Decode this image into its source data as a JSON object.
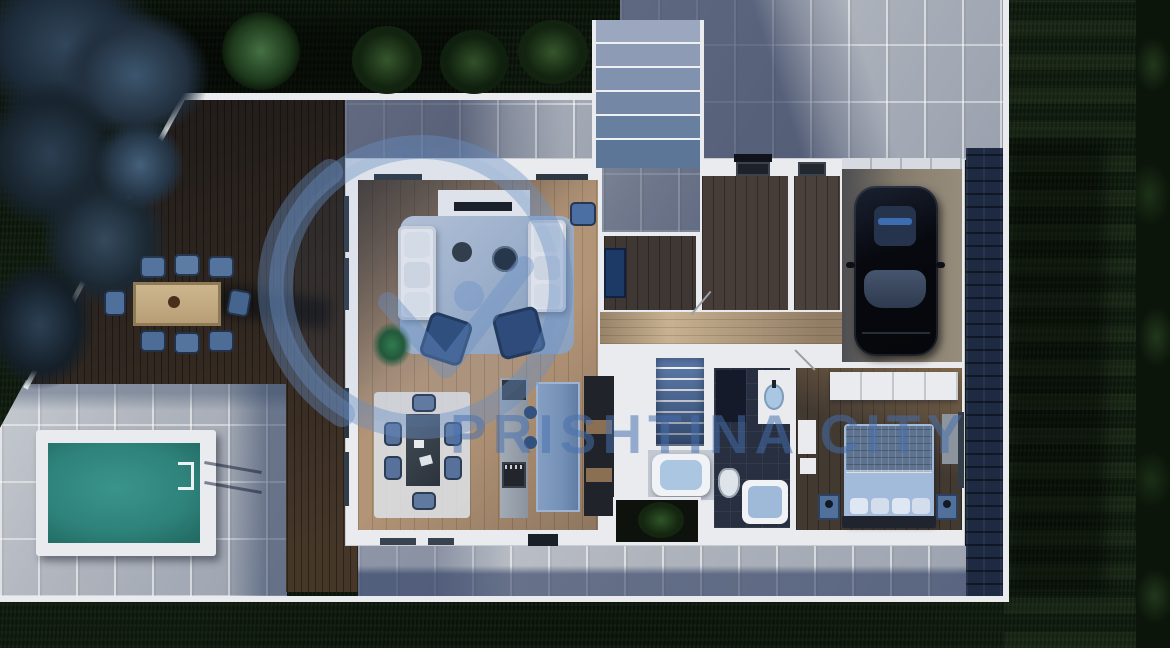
{
  "watermark": {
    "text": "PRISHTINA CITY",
    "color": "#4a76b4"
  },
  "scene": {
    "description": "Aerial top-down 3D render of a modern single-storey villa floor plan at dusk",
    "areas": [
      "garden-lawn",
      "tree-cluster",
      "driveway",
      "entry-steps",
      "terrace-deck",
      "outdoor-dining",
      "pool-patio",
      "swimming-pool",
      "living-room",
      "dining-area",
      "kitchen",
      "hallway",
      "entry-hall",
      "office",
      "staircase",
      "bathroom",
      "master-bedroom",
      "garage",
      "courtyard-planter",
      "south-walkway"
    ],
    "objects": [
      "outdoor-dining-table",
      "outdoor-chairs-x8",
      "pool-ladder",
      "white-sofas-x2",
      "tv-console",
      "coffee-tables",
      "blue-armchairs-x2",
      "house-plant",
      "indoor-dining-table",
      "indoor-chairs-x6",
      "kitchen-island",
      "cooktop-oven",
      "appliance-wall",
      "double-bed",
      "nightstands-x2",
      "wardrobe",
      "bathtub",
      "vanity-sink",
      "toilet",
      "shower",
      "black-car",
      "garden-bushes-x3",
      "round-tree"
    ]
  },
  "palette": {
    "grass": "#0e1a0d",
    "deck_wood": "#49392a",
    "pavers": "#b5bac2",
    "shadow_blue": "#2d4060",
    "pool_water": "#2e837b",
    "roof_shingles": "#1e2a42",
    "walls": "#e9ebee",
    "light_wood_floor": "#b29477",
    "dark_wood_floor": "#3e3733",
    "corridor_wood": "#c7b191",
    "furniture_blue": "#54749e",
    "armchair_navy": "#2b4a79",
    "car_black": "#0b0e14",
    "watermark_blue": "#4a76b4"
  }
}
